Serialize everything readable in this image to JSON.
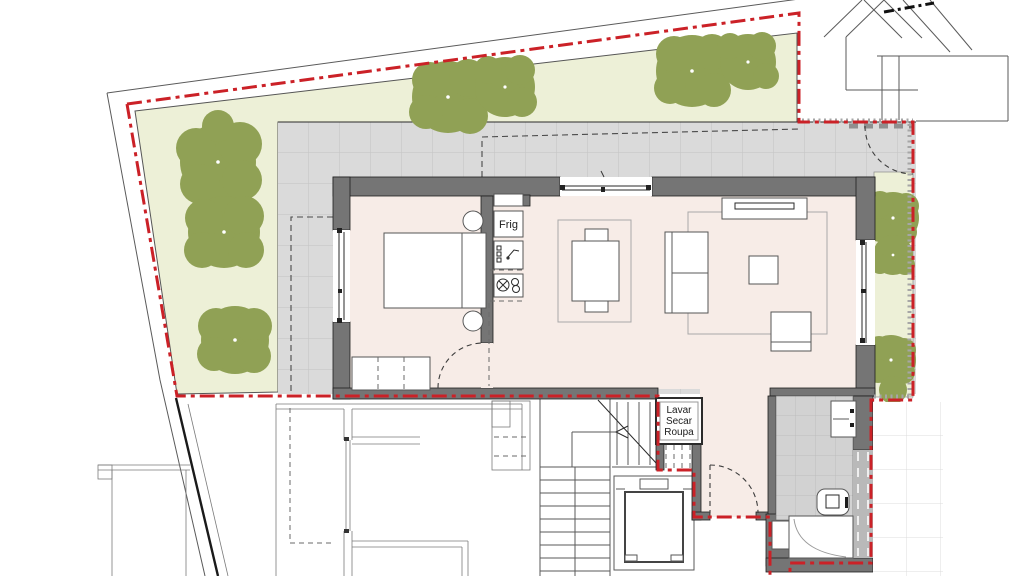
{
  "labels": {
    "fridge": "Frig",
    "laundry": [
      "Lavar",
      "Secar",
      "Roupa"
    ]
  },
  "colors": {
    "boundary_red": "#cb2127",
    "lawn_green": "#edf0d7",
    "tree_green": "#90a155",
    "tree_green_dark": "#75853f",
    "wall_gray": "#757575",
    "floor_pink": "#f7ece7",
    "paving_gray": "#dadada",
    "paving_line": "#c3c3c3",
    "bath_tile_gray": "#d2d2d2",
    "bath_tile_line": "#bdbdbd",
    "fence_gray": "#a6a6a6",
    "gate_dash_gray": "#8f8f8f"
  }
}
